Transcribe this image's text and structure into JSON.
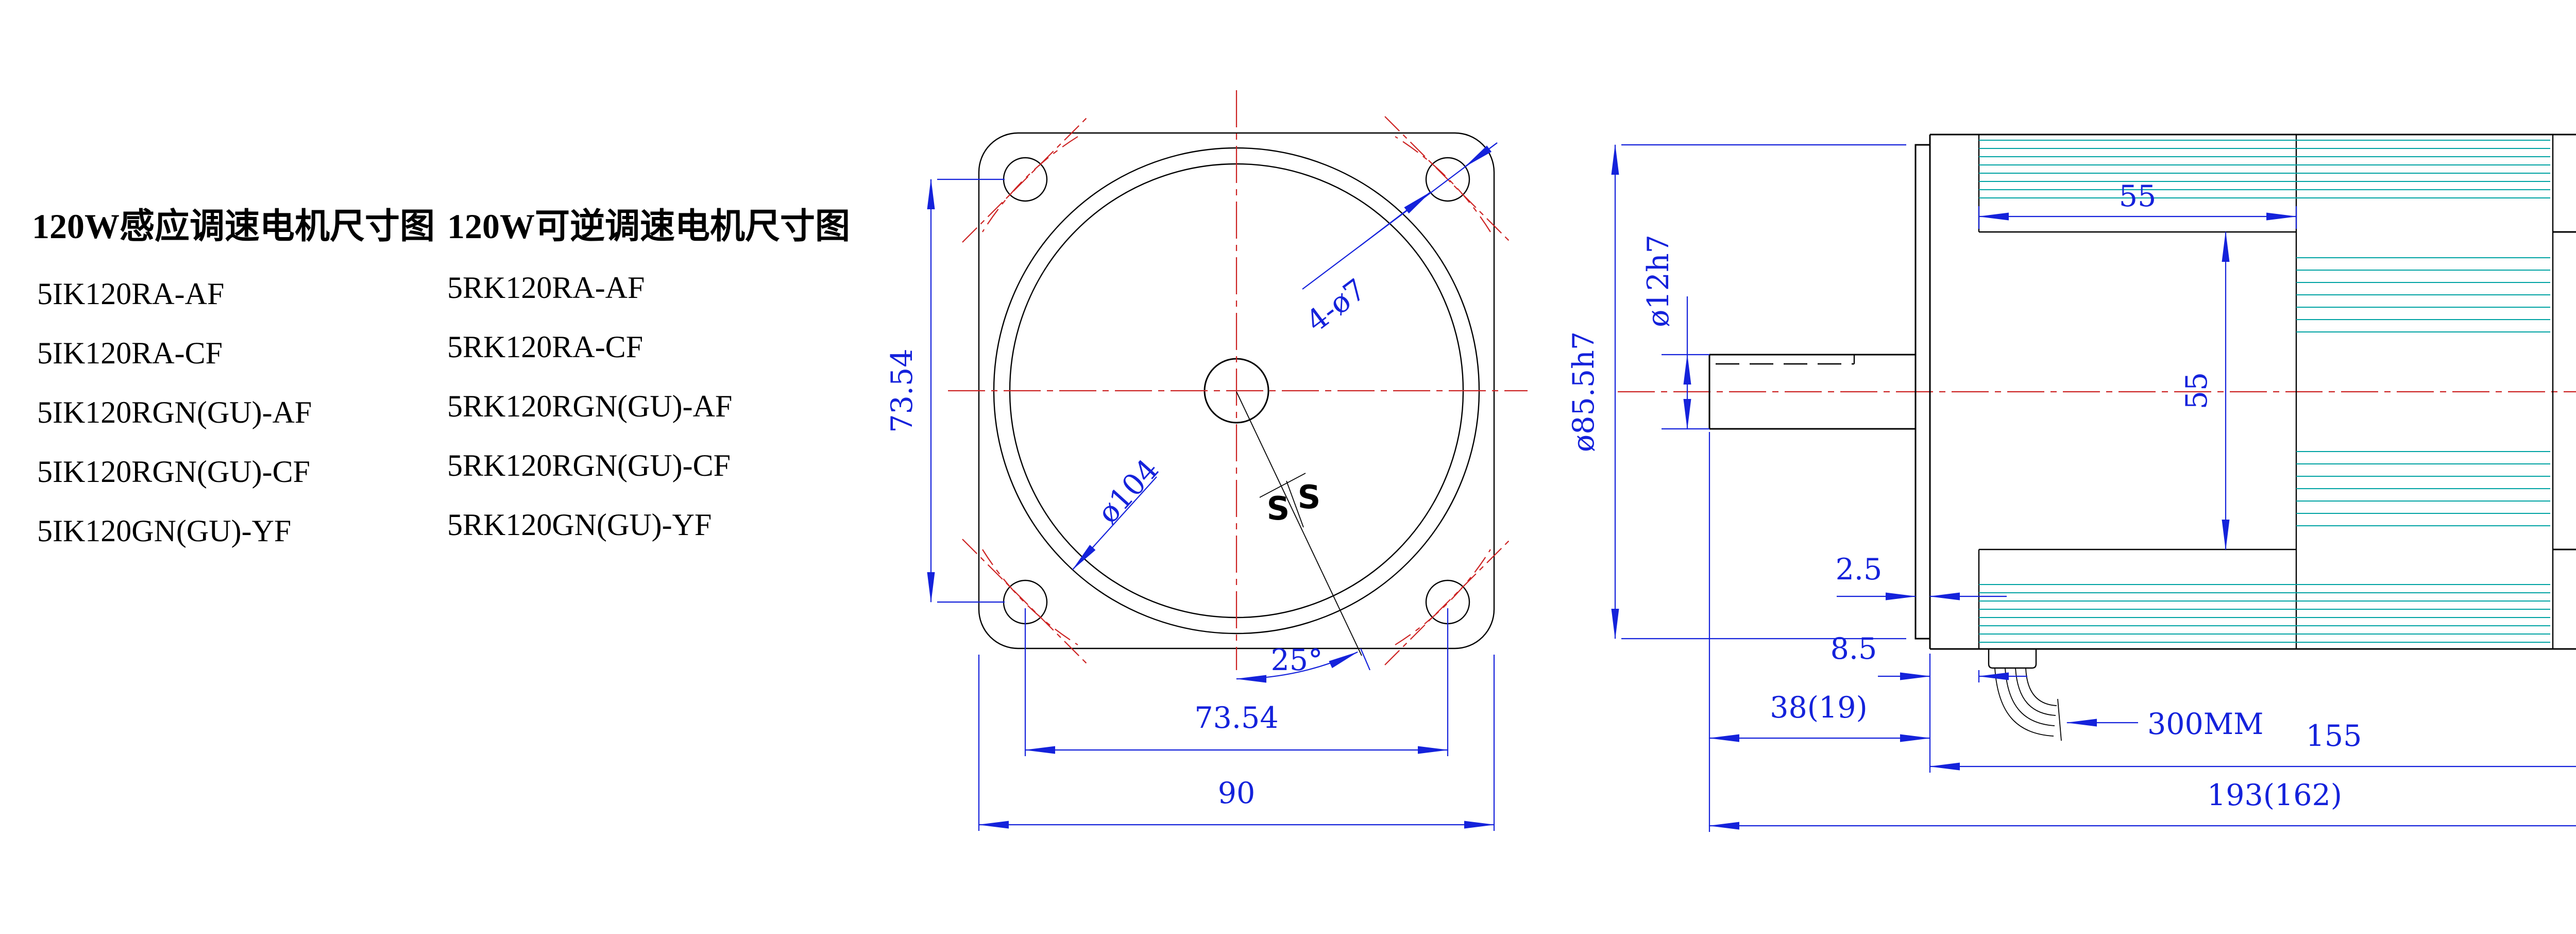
{
  "theme": {
    "background": "#ffffff",
    "dimension_color": "#1422db",
    "centerline_color": "#cc2222",
    "fin_color": "#00a3a3",
    "outline_color": "#000000"
  },
  "header": {
    "title_induction": "120W感应调速电机尺寸图",
    "title_reversible": "120W可逆调速电机尺寸图"
  },
  "model_lists": {
    "induction": [
      "5IK120RA-AF",
      "5IK120RA-CF",
      "5IK120RGN(GU)-AF",
      "5IK120RGN(GU)-CF",
      "5IK120GN(GU)-YF"
    ],
    "reversible": [
      "5RK120RA-AF",
      "5RK120RA-CF",
      "5RK120RGN(GU)-AF",
      "5RK120RGN(GU)-CF",
      "5RK120GN(GU)-YF"
    ]
  },
  "front_view": {
    "dim_hole_pitch_vertical": "73.54",
    "dim_hole_pitch_horizontal": "73.54",
    "dim_frame_size": "90",
    "label_mounting_holes": "4-ø7",
    "label_body_diameter": "ø104",
    "dim_cable_angle": "25°",
    "seal_mark_left": "S",
    "seal_mark_right": "S"
  },
  "side_view": {
    "dim_pilot_diameter": "ø85.5h7",
    "dim_shaft_diameter": "ø12h7",
    "dim_fin_section_length": "55",
    "dim_front_section_height": "55",
    "dim_body_height": "89",
    "dim_flange_thickness": "2.5",
    "dim_flange_to_body": "8.5",
    "dim_shaft_length": "38(19)",
    "dim_body_length": "155",
    "dim_total_length": "193(162)",
    "label_cable_length": "300MM"
  }
}
